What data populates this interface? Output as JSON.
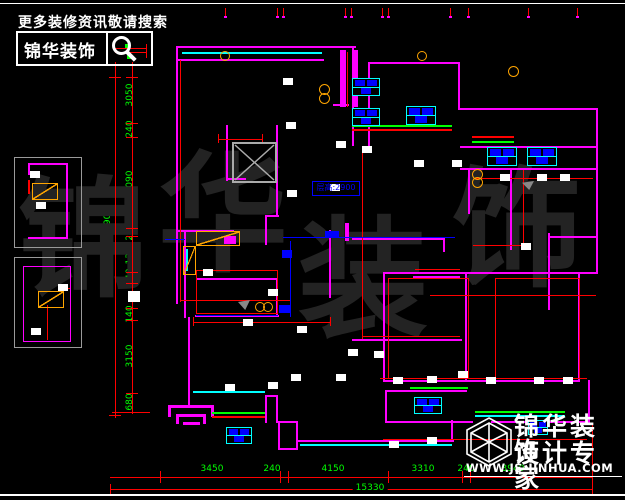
{
  "header": {
    "promo": "更多装修资讯敬请搜索",
    "brand": "锦华装饰"
  },
  "watermark": {
    "chars": [
      "锦",
      "华",
      "装",
      "饰"
    ]
  },
  "annotations": {
    "floor_height": "层高:2900"
  },
  "dimensions": {
    "bottom": {
      "segments": [
        "3450",
        "240",
        "4150",
        "3310",
        "240",
        "3940"
      ],
      "total": "15330"
    },
    "left": {
      "segments": [
        "3050",
        "240",
        "4090",
        "230",
        "1360",
        "140",
        "140",
        "3150",
        "680"
      ],
      "total": "14790"
    }
  },
  "footer": {
    "brand_line1": "锦华装饰",
    "brand_line2": "设计专家",
    "website": "WWW.JS-JINHUA.COM"
  },
  "colors": {
    "wall": "#ff00ff",
    "dimension": "#ff0000",
    "dim_text": "#00ff00",
    "window": "#00ffff",
    "plumbing": "#ffa500",
    "water_line": "#0000ff",
    "background": "#000000",
    "watermark": "#232323"
  }
}
